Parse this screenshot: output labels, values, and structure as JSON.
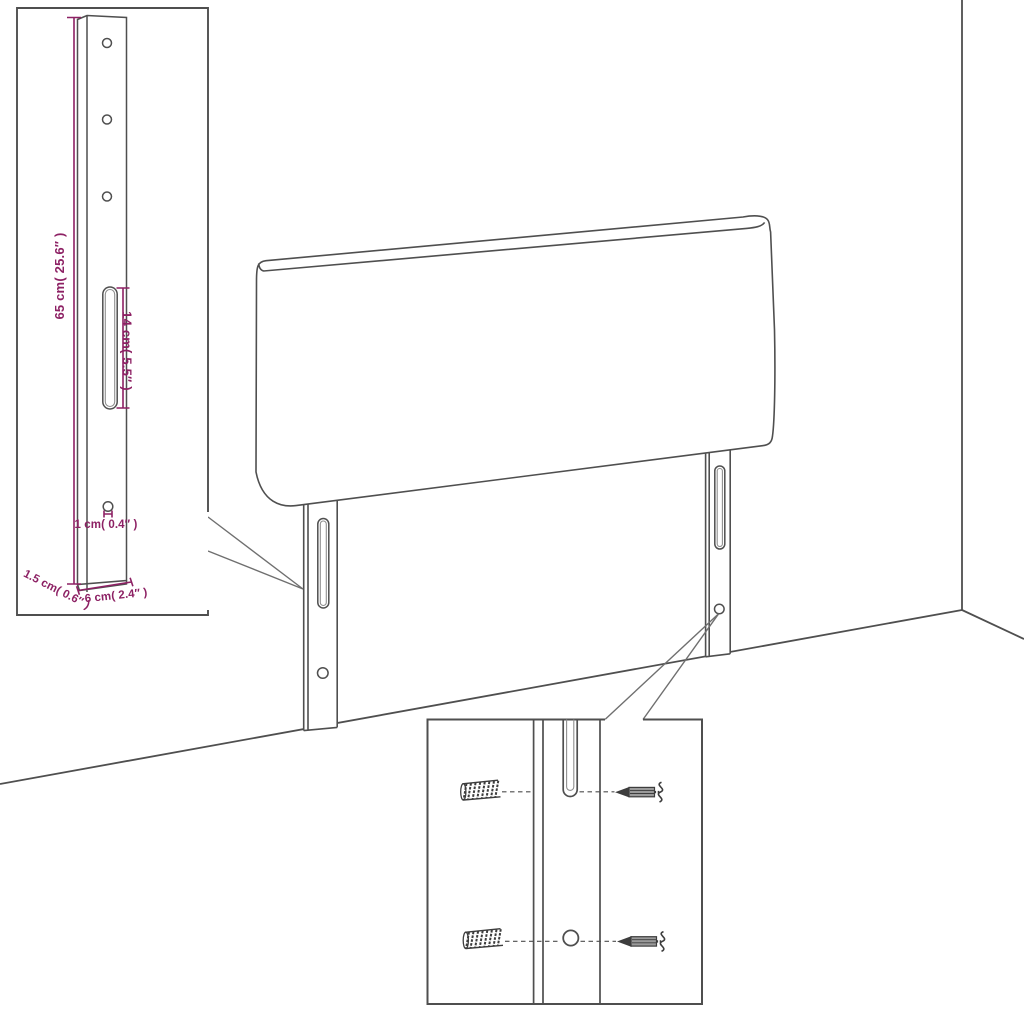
{
  "colors": {
    "background": "#ffffff",
    "outline": "#4f4f4f",
    "outline_soft": "#8f8f8f",
    "hardware": "#3d3d3d",
    "callout": "#6f6f6f",
    "dimension": "#8d2164"
  },
  "inset_leg": {
    "labels": {
      "height": "65 cm( 25.6″ )",
      "slot_length": "14 cm( 5.5″ )",
      "hole_diameter": "1 cm( 0.4″ )",
      "thickness": "1.5 cm( 0.6″ )",
      "width": "6 cm( 2.4″ )"
    }
  }
}
